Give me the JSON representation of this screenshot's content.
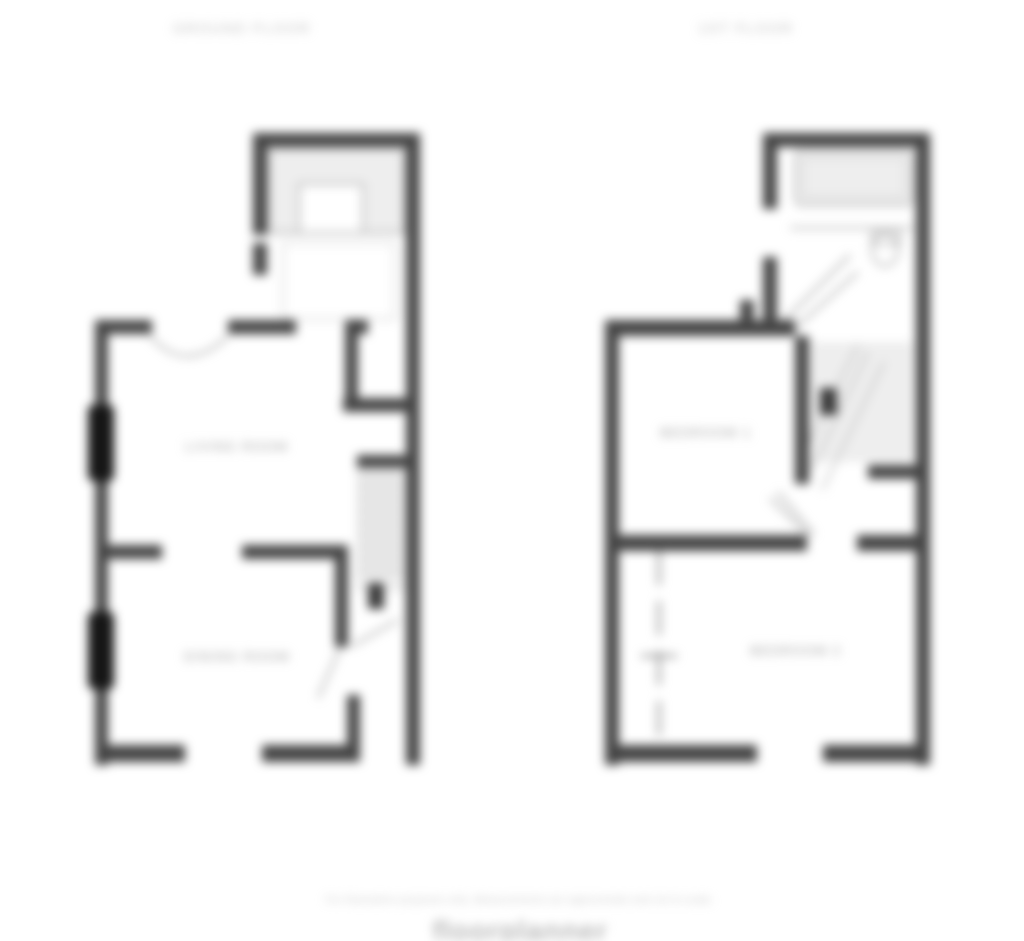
{
  "page": {
    "width": 1024,
    "height": 941,
    "background": "#ffffff",
    "blur_px": 5
  },
  "colors": {
    "background": "#ffffff",
    "wall": "#454545",
    "window": "#161616",
    "door": "#3a3a3a",
    "fixture": "#b8b8b8",
    "fixture-light": "#d6d6d6",
    "wash": "#eeeeee",
    "stair": "#c6c6c6",
    "swing": "#9c9c9c",
    "thinwall": "#8f8f8f",
    "label": "#9e9e9e",
    "title": "#bdbdbd",
    "disclaimer": "#c2c2c2",
    "brand": "#b9b9b9"
  },
  "plans": [
    {
      "title": "GROUND FLOOR",
      "rooms": [
        {
          "label": "LIVING ROOM"
        },
        {
          "label": "DINING ROOM"
        }
      ]
    },
    {
      "title": "1ST FLOOR",
      "rooms": [
        {
          "label": "BEDROOM 1"
        },
        {
          "label": "BEDROOM 2"
        }
      ]
    }
  ],
  "footer": {
    "disclaimer": "For illustrative purposes only. Measurements are approximate and not to scale.",
    "brand": "floorplanner"
  }
}
